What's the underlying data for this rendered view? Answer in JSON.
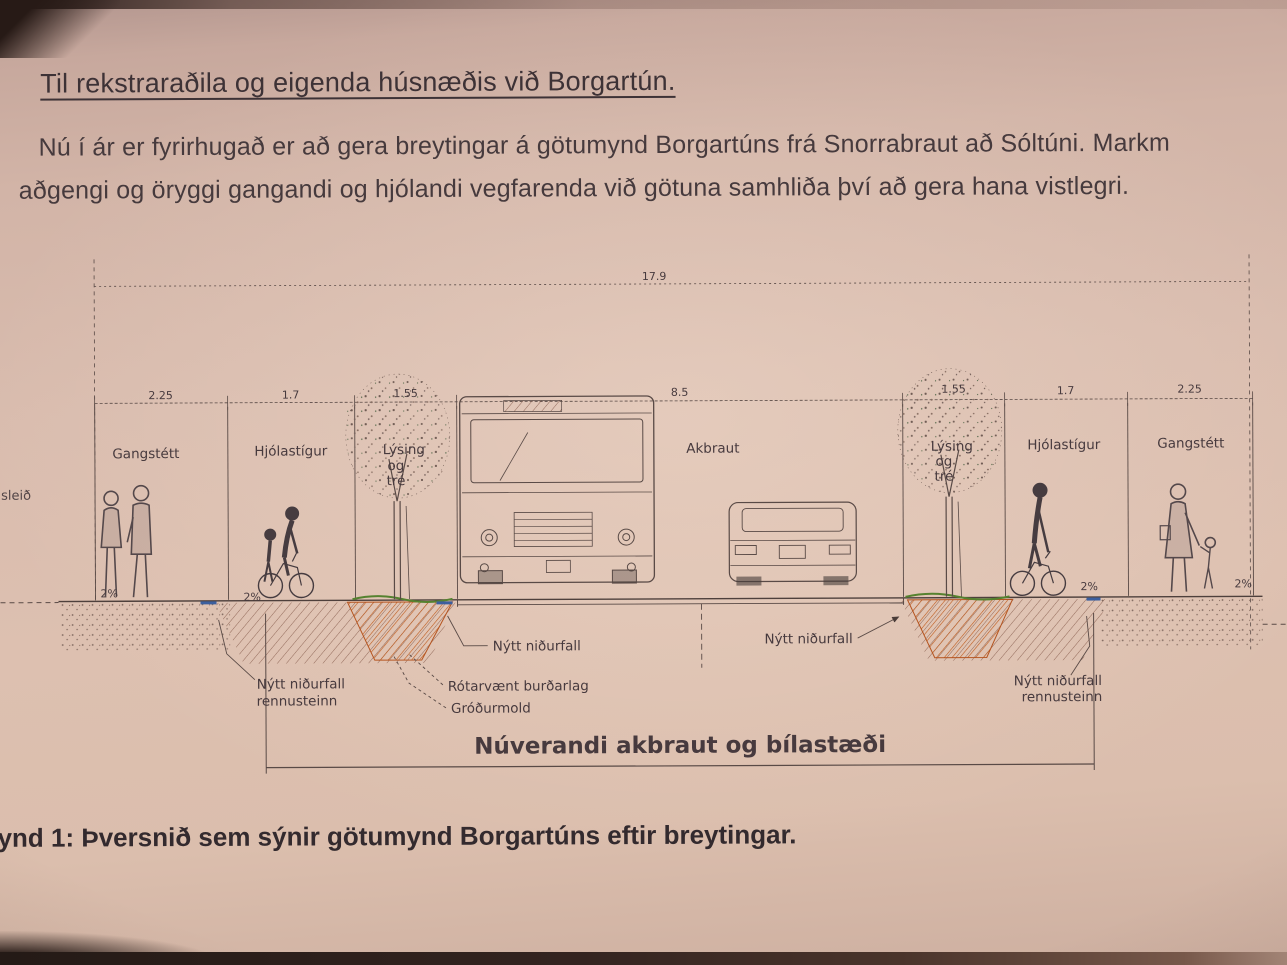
{
  "letter": {
    "title": "Til rekstraraðila og eigenda húsnæðis við Borgartún.",
    "body_line1": "Nú í ár er fyrirhugað er að gera breytingar á götumynd Borgartúns frá Snorrabraut að Sóltúni. Markm",
    "body_line2": "aðgengi og öryggi gangandi og hjólandi vegfarenda við götuna samhliða því að gera hana vistlegri.",
    "margin_fragment": "sleið",
    "figure_caption": "ynd 1: Þversnið sem sýnir götumynd Borgartúns eftir breytingar."
  },
  "diagram": {
    "total_width": "17.9",
    "sections": [
      {
        "label": "Gangstétt",
        "width": "2.25"
      },
      {
        "label": "Hjólastígur",
        "width": "1.7"
      },
      {
        "label": "Lýsing og tré",
        "width": "1.55"
      },
      {
        "label": "Akbraut",
        "width": "8.5"
      },
      {
        "label": "Lýsing og tré",
        "width": "1.55"
      },
      {
        "label": "Hjólastígur",
        "width": "1.7"
      },
      {
        "label": "Gangstétt",
        "width": "2.25"
      }
    ],
    "tree_zone_lines": [
      "Lýsing",
      "og",
      "tré"
    ],
    "slope_label": "2%",
    "annotations": {
      "new_drain": "Nýtt niðurfall",
      "new_drain_kerb_line1": "Nýtt niðurfall",
      "new_drain_kerb_line2": "rennusteinn",
      "root_friendly_base": "Rótarvænt burðarlag",
      "topsoil": "Gróðurmold",
      "existing_road": "Núverandi akbraut og bílastæði"
    },
    "colors": {
      "ink": "#42363a",
      "drawing_line": "#594a46",
      "tree_pit_orange": "#b5541f",
      "grass_green": "#55822f",
      "kerb_blue": "#3c5f9e",
      "paper": "#d9bcae"
    }
  }
}
